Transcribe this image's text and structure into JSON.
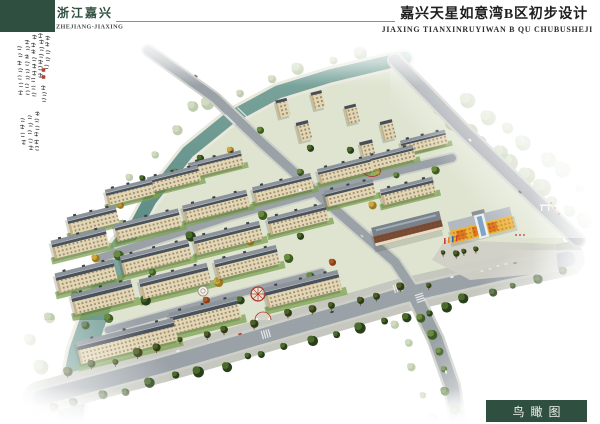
{
  "header": {
    "region_cn": "浙江嘉兴",
    "region_en": "ZHEJIANG-JIAXING",
    "title_cn": "嘉兴天星如意湾B区初步设计",
    "title_en": "JIAXING TIANXINRUYIWAN B QU CHUBUSHEJI"
  },
  "caption": {
    "label": "鸟瞰图"
  },
  "colors_ui": {
    "brand_green": "#2f5040",
    "title_ink": "#1f1f1f",
    "rule_gray": "#8f8f8f",
    "seal_red": "#a8392b"
  },
  "scene": {
    "colors": {
      "site": "#dee4d0",
      "road": "#9aa1a7",
      "curb": "#cdd0c9",
      "sidewalk": "#c6c8bf",
      "bank": "#e8e8dc",
      "river_top": "#7da69e",
      "river_bot": "#5a8a82",
      "roof_top": "#8d939b",
      "roof_bot": "#49515b",
      "facade": "#e4d6b2",
      "facade_shade": "#c6b084",
      "win": "#443f37",
      "lawn": "#7da152",
      "plaza": "#d0d0c6",
      "brown": "#7c4c34",
      "cream": "#e6dcc2",
      "school_yellow": "#f0b235",
      "school_orange": "#e2761f",
      "glass": "#7fa6c6",
      "pal": {
        "dark": [
          "#4c6a2c",
          "#27401a"
        ],
        "mid": [
          "#6a8a3e",
          "#3d5c22"
        ],
        "light": [
          "#8aa35a",
          "#5f7c35"
        ],
        "faint": [
          "#aabf8e",
          "#8ba36b"
        ],
        "yellow": [
          "#cfa93f",
          "#9c7a22"
        ],
        "red": [
          "#b05a28",
          "#8a3f16"
        ],
        "palm": [
          "#50602a",
          "#2f3c12"
        ]
      }
    },
    "site": [
      [
        408,
        62
      ],
      [
        560,
        225
      ],
      [
        568,
        258
      ],
      [
        430,
        292
      ],
      [
        200,
        354
      ],
      [
        95,
        380
      ],
      [
        92,
        310
      ],
      [
        118,
        252
      ],
      [
        146,
        204
      ],
      [
        186,
        154
      ],
      [
        228,
        122
      ],
      [
        278,
        96
      ],
      [
        330,
        80
      ]
    ],
    "river": {
      "upper": {
        "pts": [
          [
            405,
            58
          ],
          [
            330,
            76
          ],
          [
            278,
            92
          ],
          [
            230,
            118
          ],
          [
            188,
            152
          ],
          [
            150,
            200
          ],
          [
            124,
            248
          ]
        ],
        "w": 13
      },
      "lower": {
        "pts": [
          [
            124,
            248
          ],
          [
            100,
            300
          ],
          [
            82,
            352
          ],
          [
            72,
            400
          ],
          [
            70,
            424
          ]
        ],
        "w": 26
      }
    },
    "roads": [
      {
        "id": "front",
        "pts": [
          [
            40,
            398
          ],
          [
            160,
            366
          ],
          [
            280,
            331
          ],
          [
            400,
            296
          ],
          [
            500,
            273
          ],
          [
            568,
            259
          ]
        ],
        "w": 15,
        "curb": 2.5,
        "walk": 34
      },
      {
        "id": "north-entry",
        "pts": [
          [
            148,
            50
          ],
          [
            215,
            98
          ],
          [
            262,
            143
          ],
          [
            330,
            205
          ],
          [
            395,
            262
          ],
          [
            412,
            288
          ]
        ],
        "w": 9,
        "curb": 2
      },
      {
        "id": "inner-upper",
        "pts": [
          [
            100,
            258
          ],
          [
            230,
            216
          ],
          [
            360,
            180
          ],
          [
            452,
            158
          ]
        ],
        "w": 8,
        "curb": 1.8
      },
      {
        "id": "inner-lower",
        "pts": [
          [
            108,
            330
          ],
          [
            230,
            296
          ],
          [
            322,
            272
          ]
        ],
        "w": 6.5,
        "curb": 1.5
      },
      {
        "id": "east",
        "pts": [
          [
            395,
            60
          ],
          [
            465,
            132
          ],
          [
            540,
            204
          ],
          [
            578,
            240
          ]
        ],
        "w": 11,
        "curb": 2.5
      },
      {
        "id": "south-branch",
        "pts": [
          [
            412,
            290
          ],
          [
            436,
            340
          ],
          [
            452,
            386
          ],
          [
            458,
            424
          ]
        ],
        "w": 13,
        "curb": 2.5
      }
    ],
    "plaza": [
      [
        445,
        240
      ],
      [
        556,
        244
      ],
      [
        558,
        272
      ],
      [
        470,
        280
      ],
      [
        432,
        260
      ]
    ],
    "zebras": [
      [
        266,
        334,
        -16
      ],
      [
        398,
        288,
        -16
      ],
      [
        420,
        298,
        72
      ]
    ],
    "belts_bg": [
      {
        "a": [
          360,
          52
        ],
        "b": [
          210,
          100
        ],
        "n": 6,
        "r": 5,
        "pal": "faint"
      },
      {
        "a": [
          195,
          108
        ],
        "b": [
          112,
          198
        ],
        "n": 5,
        "r": 5,
        "pal": "faint"
      },
      {
        "a": [
          96,
          215
        ],
        "b": [
          52,
          318
        ],
        "n": 4,
        "r": 6,
        "pal": "faint"
      },
      {
        "a": [
          32,
          340
        ],
        "b": [
          58,
          412
        ],
        "n": 4,
        "r": 8,
        "pal": "faint"
      },
      {
        "a": [
          440,
          108
        ],
        "b": [
          596,
          232
        ],
        "n": 12,
        "r": 7,
        "pal": "faint"
      },
      {
        "a": [
          470,
          100
        ],
        "b": [
          600,
          200
        ],
        "n": 8,
        "r": 6,
        "pal": "faint"
      }
    ],
    "belts_mid": [
      {
        "a": [
          388,
          74
        ],
        "b": [
          237,
          117
        ],
        "n": 7,
        "r": 4,
        "pal": "dark"
      },
      {
        "a": [
          228,
          122
        ],
        "b": [
          130,
          246
        ],
        "n": 7,
        "r": 4,
        "pal": "dark"
      },
      {
        "a": [
          122,
          256
        ],
        "b": [
          90,
          356
        ],
        "n": 5,
        "r": 4,
        "pal": "dark"
      },
      {
        "a": [
          398,
          70
        ],
        "b": [
          570,
          232
        ],
        "n": 12,
        "r": 4,
        "pal": "dark"
      },
      {
        "a": [
          380,
          88
        ],
        "b": [
          530,
          230
        ],
        "n": 10,
        "r": 3.6,
        "pal": "mid"
      },
      {
        "a": [
          150,
          58
        ],
        "b": [
          230,
          112
        ],
        "n": 6,
        "r": 3.4,
        "pal": "dark"
      }
    ],
    "belts_fg": [
      {
        "a": [
          70,
          372
        ],
        "b": [
          250,
          323
        ],
        "n": 9,
        "r": 3.6,
        "pal": "palm"
      },
      {
        "a": [
          288,
          314
        ],
        "b": [
          425,
          283
        ],
        "n": 7,
        "r": 3.4,
        "pal": "palm"
      },
      {
        "a": [
          52,
          408
        ],
        "b": [
          250,
          358
        ],
        "n": 9,
        "r": 4.2,
        "pal": "dark"
      },
      {
        "a": [
          262,
          355
        ],
        "b": [
          432,
          311
        ],
        "n": 8,
        "r": 4.2,
        "pal": "dark"
      },
      {
        "a": [
          442,
          306
        ],
        "b": [
          560,
          273
        ],
        "n": 6,
        "r": 4,
        "pal": "dark"
      },
      {
        "a": [
          424,
          316
        ],
        "b": [
          452,
          408
        ],
        "n": 6,
        "r": 4.2,
        "pal": "mid"
      },
      {
        "a": [
          396,
          322
        ],
        "b": [
          432,
          416
        ],
        "n": 5,
        "r": 4.5,
        "pal": "faint"
      },
      {
        "a": [
          446,
          254
        ],
        "b": [
          476,
          248
        ],
        "n": 4,
        "r": 3,
        "pal": "palm"
      }
    ],
    "clusters": [
      [
        118,
        255,
        5,
        "mid"
      ],
      [
        190,
        236,
        5,
        "dark"
      ],
      [
        262,
        215,
        4.5,
        "mid"
      ],
      [
        330,
        196,
        4,
        "yellow"
      ],
      [
        145,
        300,
        5,
        "dark"
      ],
      [
        218,
        282,
        4.5,
        "yellow"
      ],
      [
        288,
        258,
        4.5,
        "mid"
      ],
      [
        108,
        318,
        4.5,
        "mid"
      ],
      [
        240,
        300,
        4,
        "dark"
      ],
      [
        310,
        276,
        4,
        "mid"
      ],
      [
        95,
        258,
        4,
        "yellow"
      ],
      [
        170,
        218,
        4,
        "mid"
      ],
      [
        240,
        195,
        4,
        "dark"
      ],
      [
        300,
        172,
        3.5,
        "mid"
      ],
      [
        200,
        158,
        3.5,
        "dark"
      ],
      [
        206,
        300,
        3.5,
        "red"
      ],
      [
        332,
        262,
        3.5,
        "red"
      ],
      [
        372,
        205,
        4,
        "yellow"
      ],
      [
        435,
        170,
        4,
        "mid"
      ],
      [
        350,
        150,
        3.5,
        "dark"
      ],
      [
        260,
        130,
        3.5,
        "mid"
      ],
      [
        230,
        150,
        3.5,
        "yellow"
      ],
      [
        310,
        148,
        3.5,
        "dark"
      ],
      [
        175,
        172,
        3.5,
        "mid"
      ],
      [
        120,
        205,
        3.5,
        "yellow"
      ],
      [
        142,
        178,
        3,
        "dark"
      ],
      [
        368,
        172,
        3,
        "yellow"
      ],
      [
        396,
        175,
        3,
        "mid"
      ],
      [
        420,
        190,
        3.5,
        "dark"
      ],
      [
        300,
        236,
        3.5,
        "dark"
      ],
      [
        152,
        272,
        3.5,
        "mid"
      ],
      [
        225,
        260,
        3.5,
        "mid"
      ],
      [
        135,
        232,
        3.5,
        "dark"
      ],
      [
        75,
        295,
        4,
        "mid"
      ],
      [
        85,
        325,
        4,
        "dark"
      ],
      [
        250,
        242,
        3.5,
        "yellow"
      ]
    ],
    "buildings": {
      "towers": [
        [
          283,
          108,
          24
        ],
        [
          318,
          100,
          24
        ],
        [
          304,
          131,
          24
        ],
        [
          352,
          114,
          24
        ],
        [
          388,
          130,
          24
        ],
        [
          368,
          151,
          24
        ]
      ],
      "slabs": [
        [
          130,
          192,
          48
        ],
        [
          174,
          179,
          52
        ],
        [
          216,
          164,
          54
        ],
        [
          424,
          142,
          46
        ],
        [
          93,
          220,
          50
        ],
        [
          80,
          243,
          56
        ],
        [
          148,
          225,
          66
        ],
        [
          216,
          206,
          66
        ],
        [
          283,
          188,
          60
        ],
        [
          345,
          170,
          54
        ],
        [
          390,
          158,
          50
        ],
        [
          86,
          276,
          60
        ],
        [
          156,
          257,
          70
        ],
        [
          228,
          238,
          68
        ],
        [
          298,
          219,
          60
        ],
        [
          350,
          193,
          50
        ],
        [
          408,
          191,
          54
        ],
        [
          103,
          297,
          62
        ],
        [
          175,
          281,
          70
        ],
        [
          247,
          262,
          64
        ],
        [
          127,
          341,
          100
        ],
        [
          205,
          315,
          70
        ],
        [
          303,
          289,
          76
        ]
      ],
      "commercial": [
        408,
        231,
        70
      ],
      "school": [
        482,
        228,
        64
      ]
    },
    "features": [
      {
        "t": "pavilion",
        "x": 203,
        "y": 291
      },
      {
        "t": "sundial",
        "x": 258,
        "y": 294
      },
      {
        "t": "ring",
        "x": 372,
        "y": 171
      },
      {
        "t": "arc",
        "x": 263,
        "y": 320
      },
      {
        "t": "gate",
        "x": 545,
        "y": 208
      },
      {
        "t": "banners",
        "x": 444,
        "y": 238
      },
      {
        "t": "flags",
        "x": 516,
        "y": 243
      },
      {
        "t": "bridge",
        "x": 234,
        "y": 116
      }
    ],
    "cars": [
      [
        178,
        351,
        -15,
        "#f2f2f2"
      ],
      [
        240,
        334,
        -15,
        "#c0392b"
      ],
      [
        332,
        312,
        -15,
        "#3a3a3a"
      ],
      [
        452,
        277,
        -14,
        "#eeeeee"
      ],
      [
        515,
        263,
        -14,
        "#999999"
      ],
      [
        470,
        140,
        44,
        "#f0f0f0"
      ],
      [
        520,
        192,
        42,
        "#444444"
      ],
      [
        178,
        63,
        36,
        "#eeeeee"
      ],
      [
        196,
        76,
        36,
        "#555555"
      ],
      [
        446,
        372,
        78,
        "#f0f0f0"
      ],
      [
        300,
        190,
        -18,
        "#ffffff"
      ],
      [
        362,
        236,
        40,
        "#cccccc"
      ]
    ],
    "parked": [
      [
        482,
        271
      ],
      [
        490,
        269
      ],
      [
        498,
        266
      ],
      [
        506,
        264
      ]
    ],
    "calligraphy": {
      "columns": [
        {
          "x": 47,
          "y": 36,
          "len": 36
        },
        {
          "x": 41,
          "y": 34,
          "len": 46
        },
        {
          "x": 34,
          "y": 36,
          "len": 64
        },
        {
          "x": 27,
          "y": 40,
          "len": 58
        },
        {
          "x": 20,
          "y": 46,
          "len": 52
        },
        {
          "x": 44,
          "y": 86,
          "len": 18
        },
        {
          "x": 37,
          "y": 112,
          "len": 42
        },
        {
          "x": 30,
          "y": 116,
          "len": 38
        },
        {
          "x": 23,
          "y": 118,
          "len": 30
        }
      ],
      "seals": [
        [
          43.5,
          70
        ],
        [
          43.5,
          77
        ]
      ]
    }
  }
}
